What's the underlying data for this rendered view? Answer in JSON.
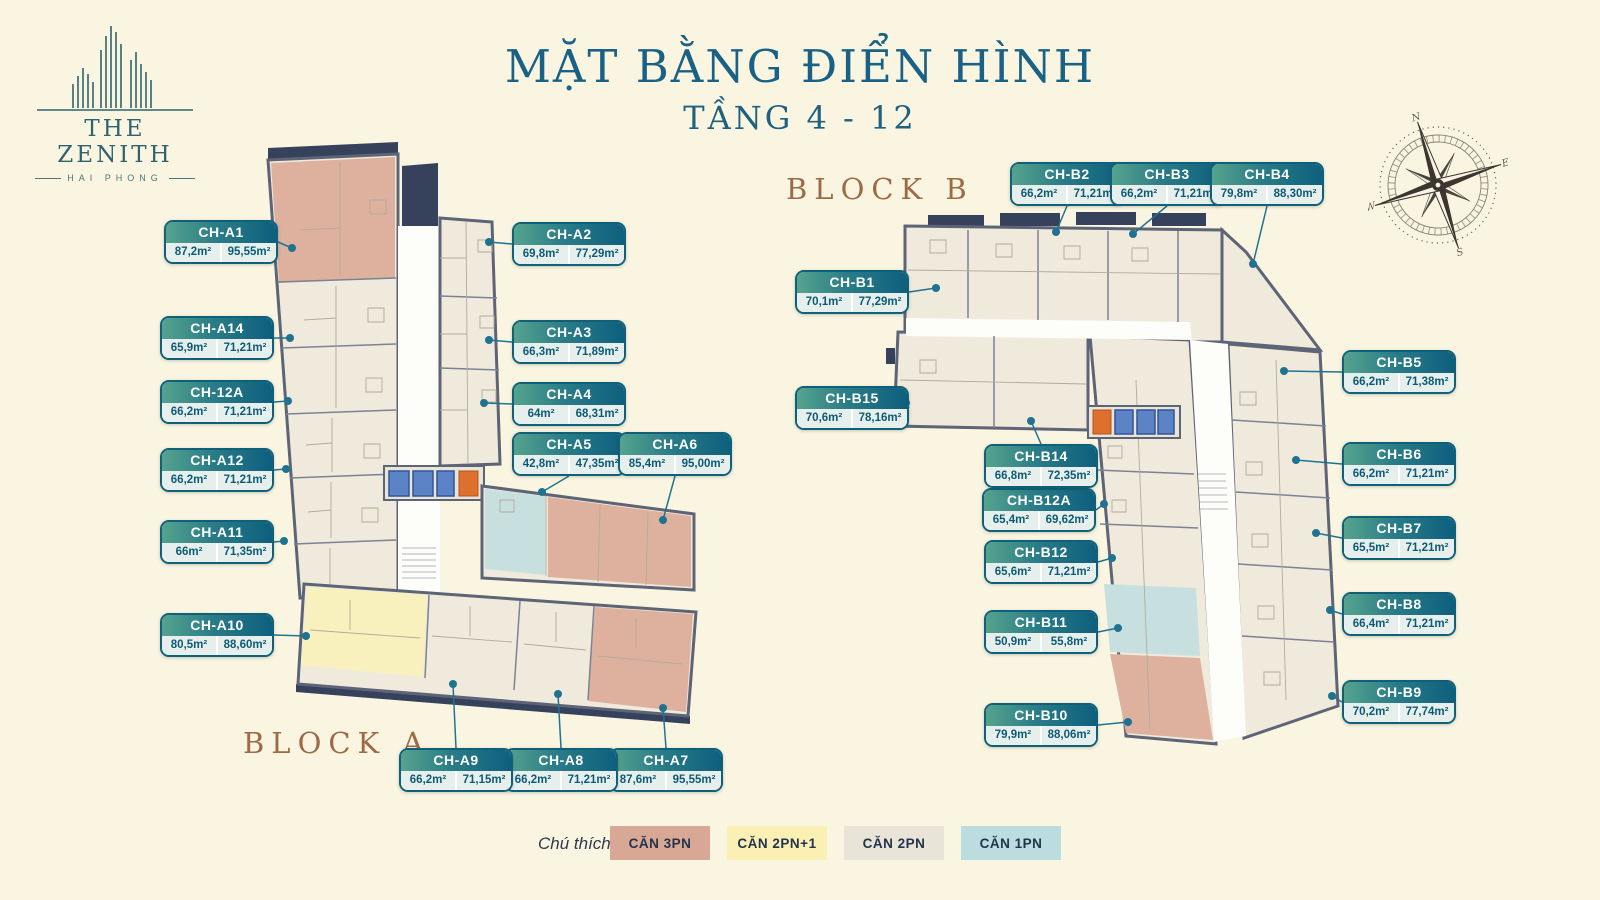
{
  "logo": {
    "name": "THE ZENITH",
    "city": "HAI PHONG"
  },
  "title": {
    "main": "MẶT BẰNG ĐIỂN HÌNH",
    "sub": "TẦNG 4 - 12"
  },
  "blocks": {
    "a_label": "BLOCK A",
    "b_label": "BLOCK B"
  },
  "legend": {
    "caption": "Chú thích:",
    "items": [
      {
        "label": "CĂN 3PN",
        "color": "#D9A795"
      },
      {
        "label": "CĂN 2PN+1",
        "color": "#FAF0B3"
      },
      {
        "label": "CĂN 2PN",
        "color": "#E8E4D8"
      },
      {
        "label": "CĂN 1PN",
        "color": "#BCDDDF"
      }
    ]
  },
  "colors": {
    "label_teal": "#0E5F7E",
    "label_gradient_start": "#55A38E",
    "title_teal": "#1A6285",
    "block_label_brown": "#9D6A45",
    "background_cream": "#FAF5E1",
    "leader_teal": "#1F7390"
  },
  "compass": {
    "icon": "compass-rose-icon",
    "directions": [
      "N",
      "E",
      "S",
      "W"
    ]
  },
  "units": {
    "a": [
      {
        "id": "CH-A1",
        "area1": "87,2m²",
        "area2": "95,55m²"
      },
      {
        "id": "CH-A2",
        "area1": "69,8m²",
        "area2": "77,29m²"
      },
      {
        "id": "CH-A3",
        "area1": "66,3m²",
        "area2": "71,89m²"
      },
      {
        "id": "CH-A4",
        "area1": "64m²",
        "area2": "68,31m²"
      },
      {
        "id": "CH-A5",
        "area1": "42,8m²",
        "area2": "47,35m²"
      },
      {
        "id": "CH-A6",
        "area1": "85,4m²",
        "area2": "95,00m²"
      },
      {
        "id": "CH-A7",
        "area1": "87,6m²",
        "area2": "95,55m²"
      },
      {
        "id": "CH-A8",
        "area1": "66,2m²",
        "area2": "71,21m²"
      },
      {
        "id": "CH-A9",
        "area1": "66,2m²",
        "area2": "71,15m²"
      },
      {
        "id": "CH-A10",
        "area1": "80,5m²",
        "area2": "88,60m²"
      },
      {
        "id": "CH-A11",
        "area1": "66m²",
        "area2": "71,35m²"
      },
      {
        "id": "CH-A12",
        "area1": "66,2m²",
        "area2": "71,21m²"
      },
      {
        "id": "CH-12A",
        "area1": "66,2m²",
        "area2": "71,21m²"
      },
      {
        "id": "CH-A14",
        "area1": "65,9m²",
        "area2": "71,21m²"
      }
    ],
    "b": [
      {
        "id": "CH-B1",
        "area1": "70,1m²",
        "area2": "77,29m²"
      },
      {
        "id": "CH-B2",
        "area1": "66,2m²",
        "area2": "71,21m²"
      },
      {
        "id": "CH-B3",
        "area1": "66,2m²",
        "area2": "71,21m²"
      },
      {
        "id": "CH-B4",
        "area1": "79,8m²",
        "area2": "88,30m²"
      },
      {
        "id": "CH-B5",
        "area1": "66,2m²",
        "area2": "71,38m²"
      },
      {
        "id": "CH-B6",
        "area1": "66,2m²",
        "area2": "71,21m²"
      },
      {
        "id": "CH-B7",
        "area1": "65,5m²",
        "area2": "71,21m²"
      },
      {
        "id": "CH-B8",
        "area1": "66,4m²",
        "area2": "71,21m²"
      },
      {
        "id": "CH-B9",
        "area1": "70,2m²",
        "area2": "77,74m²"
      },
      {
        "id": "CH-B10",
        "area1": "79,9m²",
        "area2": "88,06m²"
      },
      {
        "id": "CH-B11",
        "area1": "50,9m²",
        "area2": "55,8m²"
      },
      {
        "id": "CH-B12",
        "area1": "65,6m²",
        "area2": "71,21m²"
      },
      {
        "id": "CH-B12A",
        "area1": "65,4m²",
        "area2": "69,62m²"
      },
      {
        "id": "CH-B14",
        "area1": "66,8m²",
        "area2": "72,35m²"
      },
      {
        "id": "CH-B15",
        "area1": "70,6m²",
        "area2": "78,16m²"
      }
    ]
  }
}
